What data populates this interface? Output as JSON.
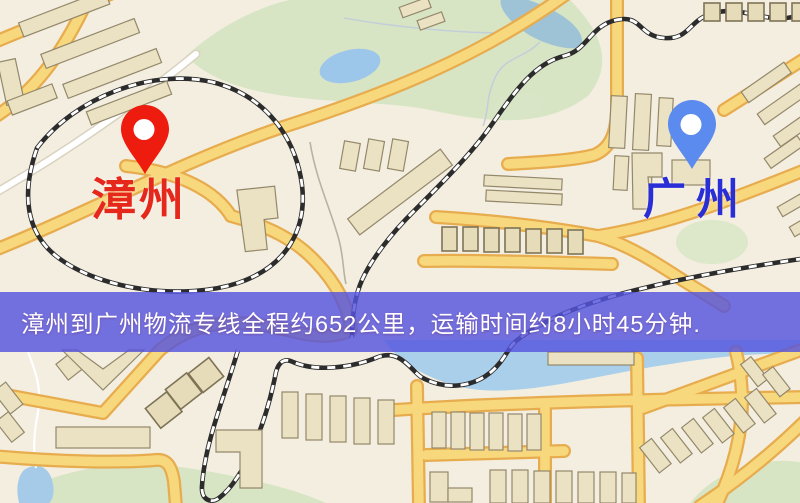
{
  "map": {
    "origin": {
      "label": "漳州",
      "marker_color": "#ee1c0e",
      "label_color": "#e6281c"
    },
    "destination": {
      "label": "广州",
      "marker_color": "#5b8bee",
      "label_color": "#2a2ed6"
    }
  },
  "banner": {
    "text": "漳州到广州物流专线全程约652公里，运输时间约8小时45分钟.",
    "background_color": "rgba(86,84,221,0.82)",
    "text_color": "#ffffff"
  },
  "route": {
    "from": "漳州",
    "to": "广州",
    "distance_text": "652公里",
    "duration_text": "8小时45分钟"
  }
}
